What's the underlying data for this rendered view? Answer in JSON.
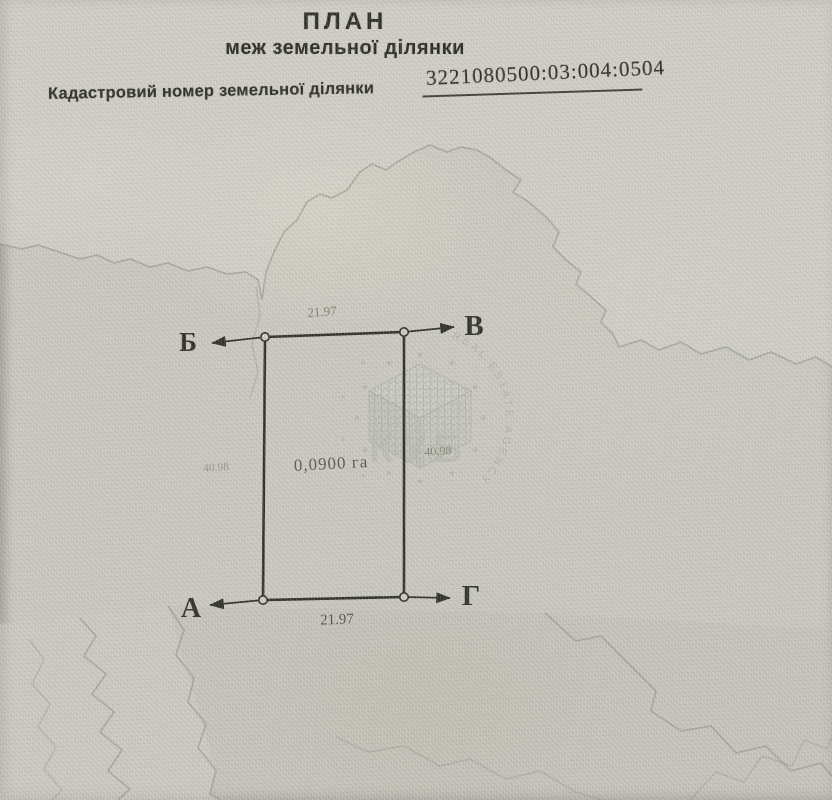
{
  "header": {
    "title": "ПЛАН",
    "subtitle": "меж земельної ділянки",
    "cadastral_label": "Кадастровий номер земельної ділянки",
    "cadastral_number": "3221080500:03:004:0504"
  },
  "plot": {
    "area": "0,0900 га",
    "corner_labels": {
      "top_left": "Б",
      "top_right": "В",
      "bottom_left": "А",
      "bottom_right": "Г"
    },
    "dimensions": {
      "top": "21.97",
      "bottom": "21.97",
      "left": "40.98",
      "right": "40.98"
    }
  },
  "watermark": {
    "ring_text": "REAL ESTATE AGENCY",
    "center_text": "КУБ"
  },
  "colors": {
    "paper": "#c8c6be",
    "ink": "#2d2d27",
    "dimension_text": "#7b7b6d",
    "contour": "#878c82",
    "stamp": "#9aa093"
  }
}
